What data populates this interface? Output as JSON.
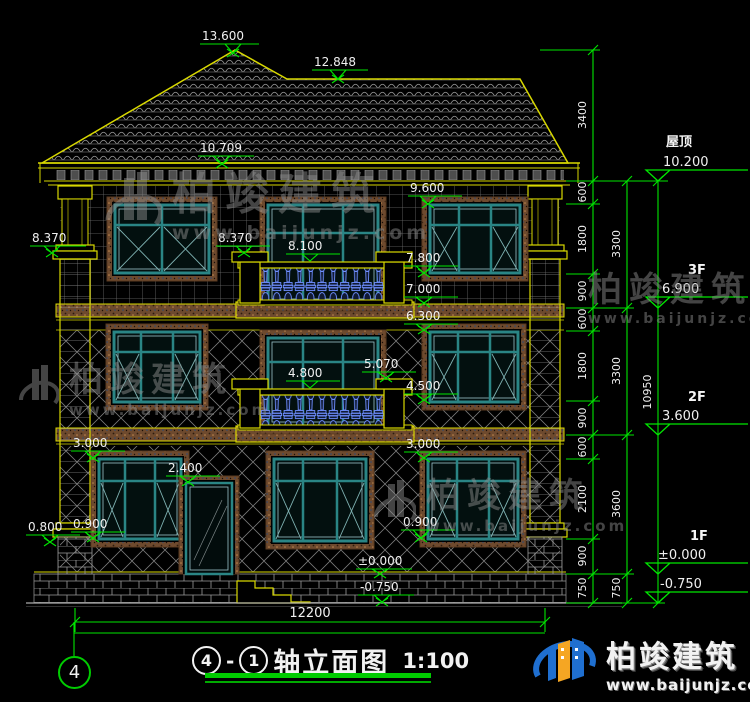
{
  "title": {
    "axis_from": "4",
    "axis_to": "1",
    "text": "轴立面图",
    "scale": "1:100"
  },
  "axis_bubble": {
    "label": "4"
  },
  "bottom_dim": {
    "value": "12200"
  },
  "watermark": {
    "brand": "柏竣建筑",
    "url": "www.baijunjz.com"
  },
  "logo": {
    "brand": "柏竣建筑",
    "url": "www.baijunjz.com"
  },
  "levels": {
    "ridge": "13.600",
    "ridge2": "12.848",
    "eave": "10.709",
    "win3_top": "9.600",
    "cap_left": "8.370",
    "cap_balcony": "8.370",
    "rail3": "8.100",
    "win3_sill": "7.800",
    "band3_top": "7.000",
    "band3_bot": "6.300",
    "post2": "5.070",
    "rail2": "4.800",
    "win2_sill": "4.500",
    "win1_top_left": "3.000",
    "win1_top_right": "3.000",
    "door_top": "2.400",
    "win1_sill_left": "0.900",
    "win1_sill_right": "0.900",
    "base_left": "0.800",
    "ground": "±0.000",
    "grade": "-0.750"
  },
  "dims": {
    "roof_height": "3400",
    "col1": [
      "600",
      "1800",
      "900",
      "600",
      "1800",
      "900",
      "600",
      "2100",
      "900",
      "750"
    ],
    "col2": [
      "3300",
      "3300",
      "3600",
      "750"
    ],
    "total": "10950"
  },
  "floors": [
    {
      "name": "屋顶",
      "elev": "10.200"
    },
    {
      "name": "3F",
      "elev": "6.900"
    },
    {
      "name": "2F",
      "elev": "3.600"
    },
    {
      "name": "1F",
      "elev": "±0.000"
    },
    {
      "name": "",
      "elev": "-0.750"
    }
  ]
}
